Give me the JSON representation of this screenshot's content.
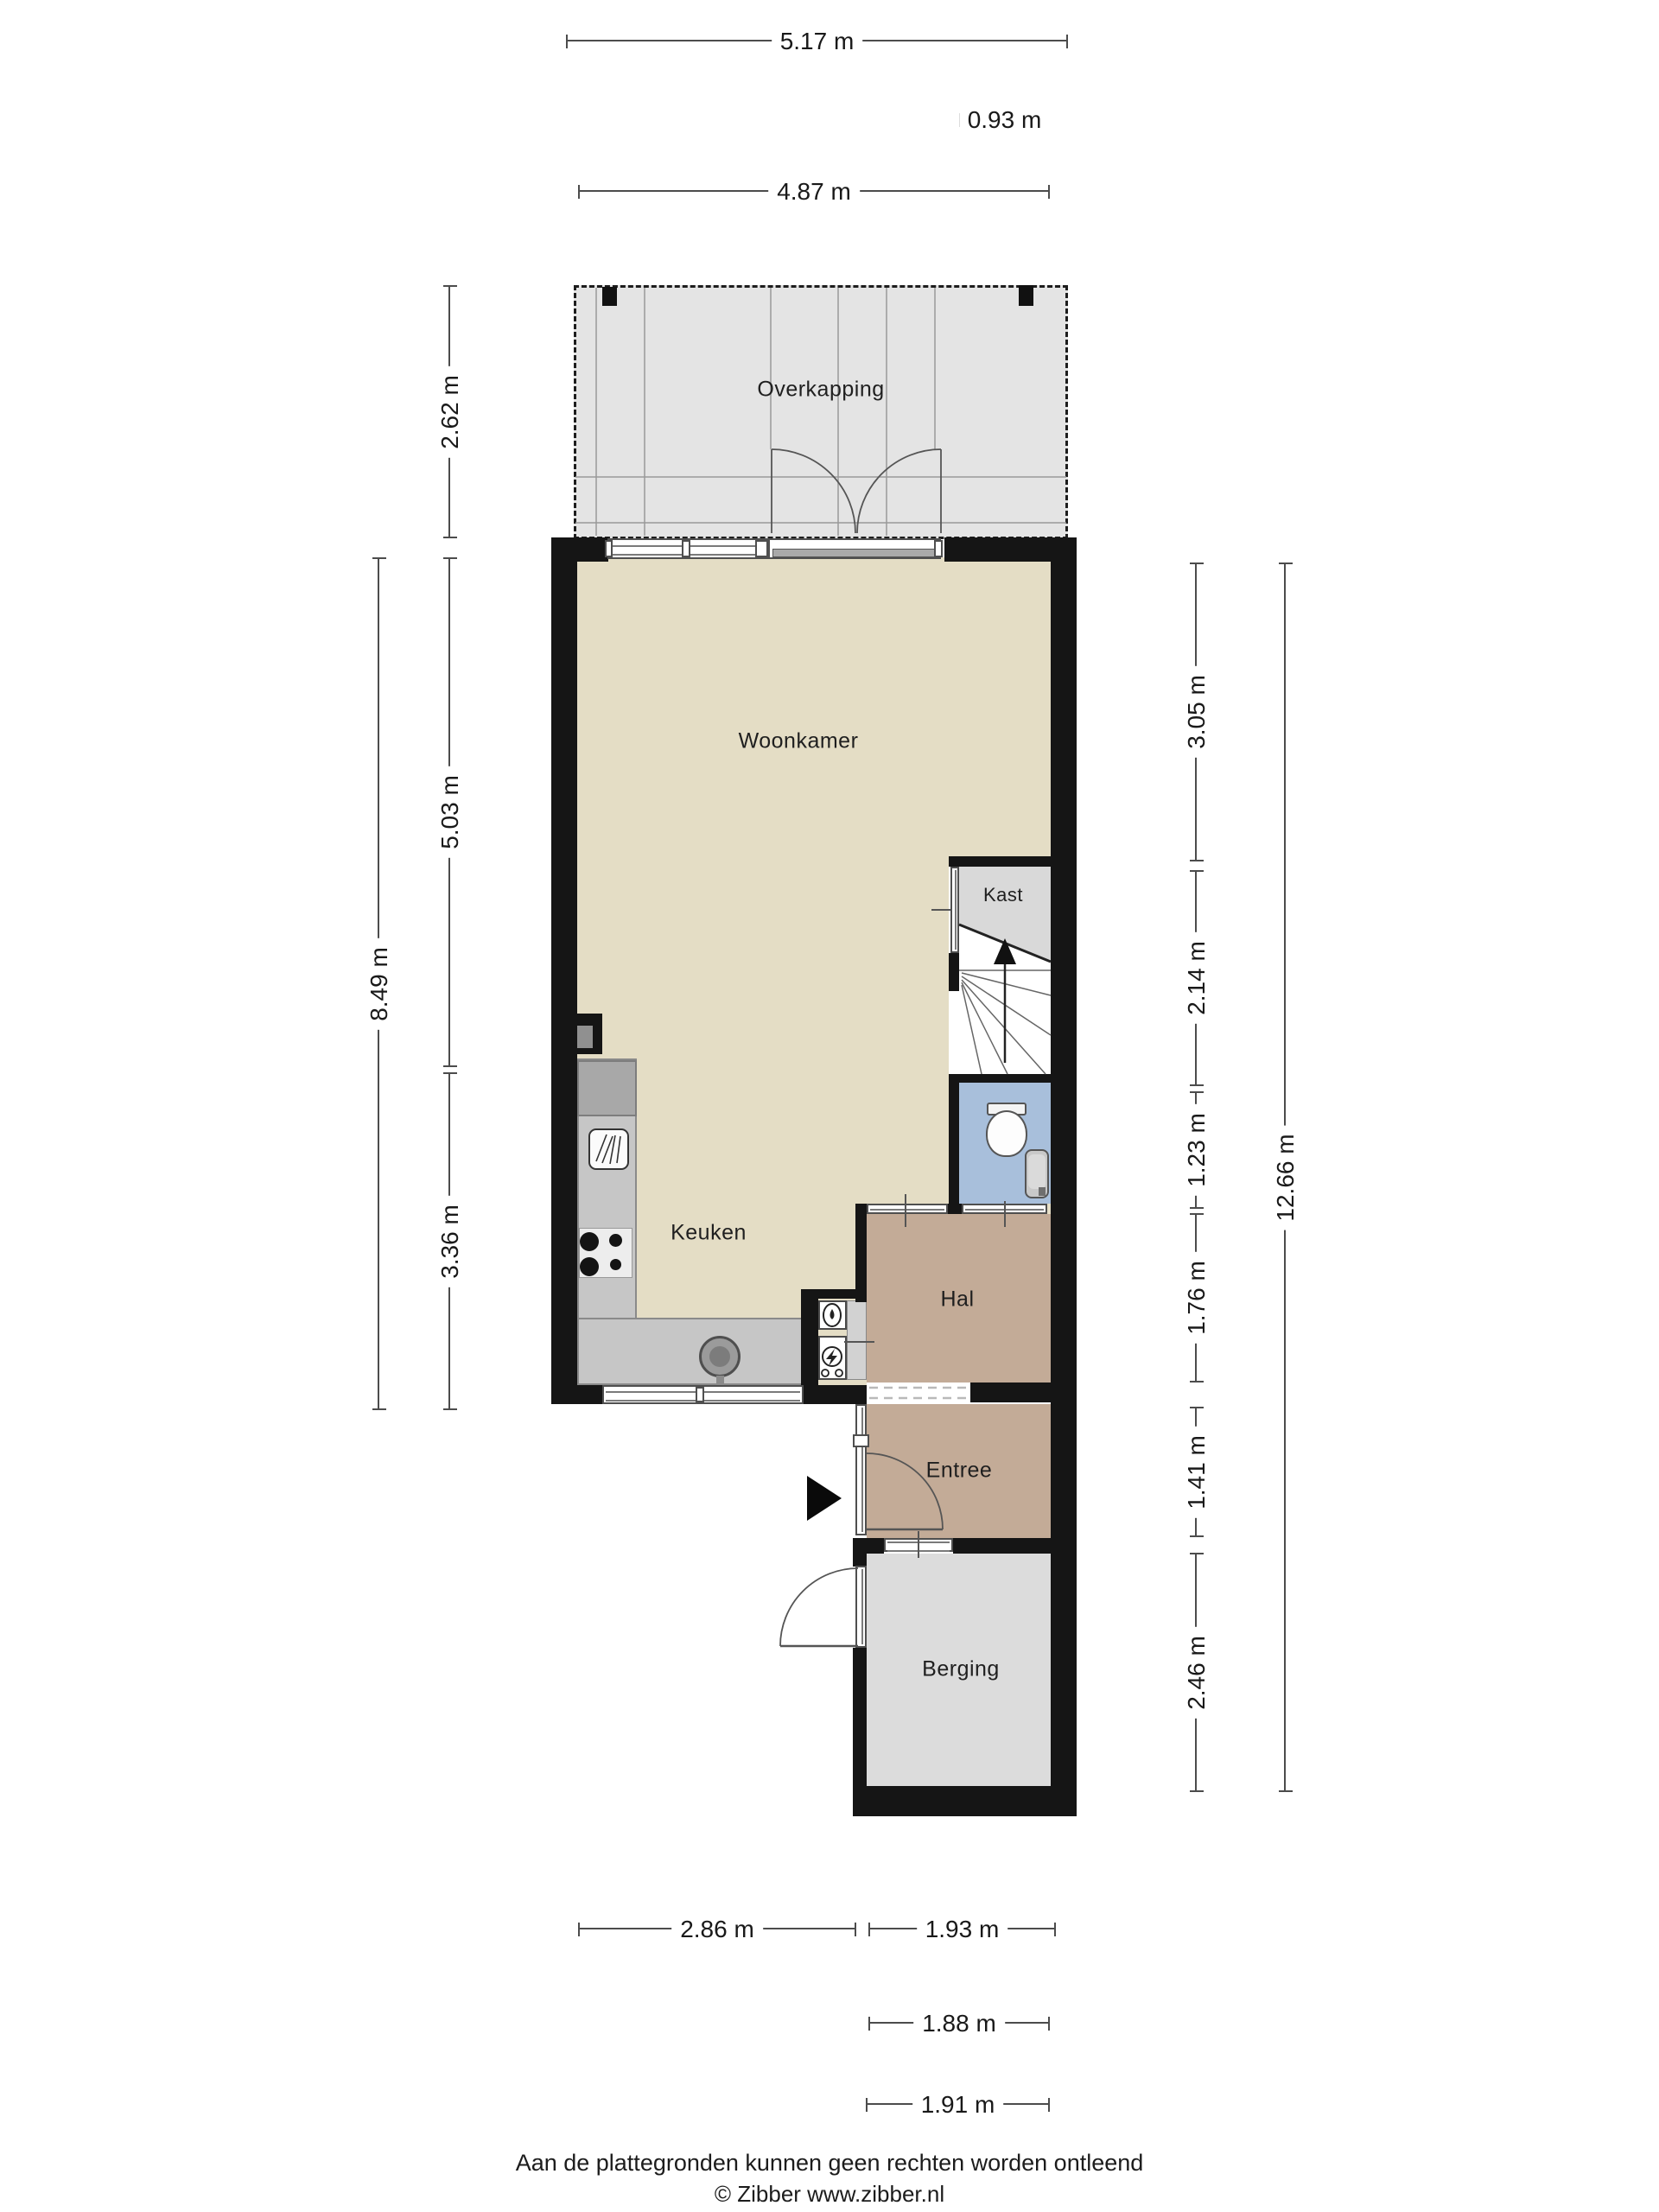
{
  "rooms": {
    "overkapping": {
      "label": "Overkapping",
      "floor_color": "#e4e4e4"
    },
    "woonkamer": {
      "label": "Woonkamer",
      "floor_color": "#e4ddc5"
    },
    "kast": {
      "label": "Kast",
      "floor_color": "#dadada"
    },
    "keuken": {
      "label": "Keuken",
      "floor_color": "#e4ddc5"
    },
    "hal": {
      "label": "Hal",
      "floor_color": "#c3ab97"
    },
    "entree": {
      "label": "Entree",
      "floor_color": "#c3ab97"
    },
    "berging": {
      "label": "Berging",
      "floor_color": "#dcdcdc"
    },
    "toilet": {
      "label": "",
      "floor_color": "#a8bfdb"
    }
  },
  "dims": {
    "t1": {
      "label": "5.17 m"
    },
    "t2": {
      "label": "0.93 m"
    },
    "t3": {
      "label": "4.87 m"
    },
    "l1": {
      "label": "2.62 m"
    },
    "l2": {
      "label": "5.03 m"
    },
    "l3": {
      "label": "3.36 m"
    },
    "l4": {
      "label": "8.49 m"
    },
    "r1": {
      "label": "3.05 m"
    },
    "r2": {
      "label": "2.14 m"
    },
    "r3": {
      "label": "1.23 m"
    },
    "r4": {
      "label": "1.76 m"
    },
    "r5": {
      "label": "1.41 m"
    },
    "r6": {
      "label": "2.46 m"
    },
    "r7": {
      "label": "12.66 m"
    },
    "b1": {
      "label": "2.86 m"
    },
    "b2": {
      "label": "1.93 m"
    },
    "b3": {
      "label": "1.88 m"
    },
    "b4": {
      "label": "1.91 m"
    }
  },
  "footer": {
    "line1": "Aan de plattegronden kunnen geen rechten worden ontleend",
    "line2": "© Zibber www.zibber.nl"
  },
  "colors": {
    "wall": "#151515",
    "dimension_line": "#4c4c4c",
    "stair_line": "#666666",
    "toilet_floor": "#a8bfdb",
    "counter": "#c6c6c6"
  }
}
